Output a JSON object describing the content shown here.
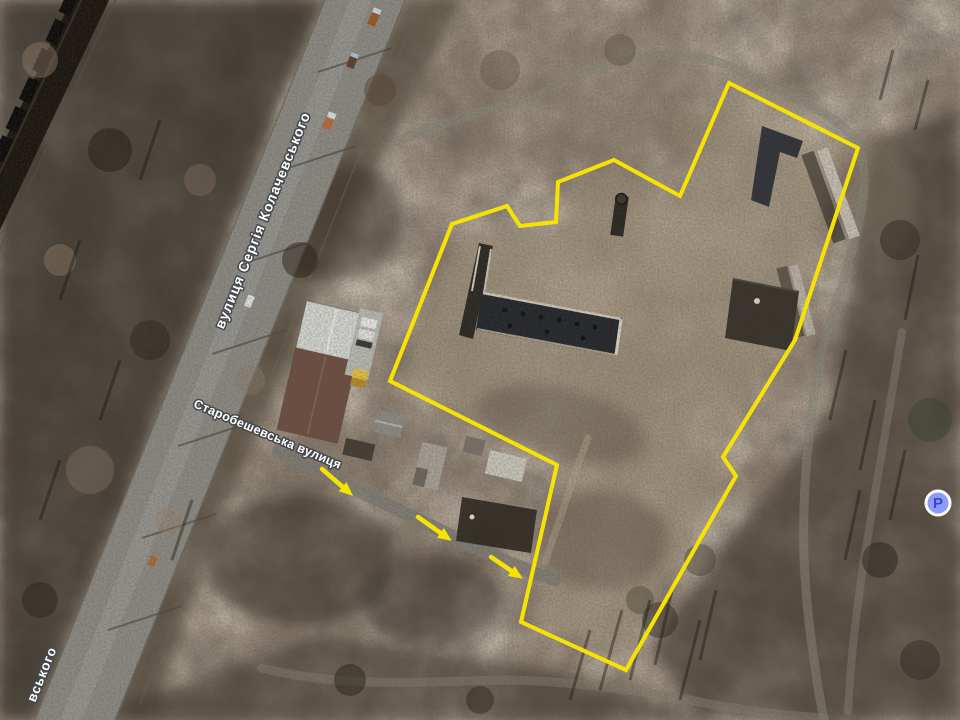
{
  "page": {
    "kind": "satellite-map-screenshot",
    "width": 960,
    "height": 720
  },
  "map": {
    "imagery": "satellite-autumn",
    "streets": {
      "main": {
        "label": "вулиця Сергія Колачевського"
      },
      "secondary": {
        "label": "Старобешевська вулиця"
      },
      "fragment": {
        "label": "вського"
      }
    },
    "poi": {
      "parking": {
        "icon": "parking-icon",
        "letter": "P",
        "circle_color": "#8a9cf7",
        "letter_color": "#3847c0",
        "ring_color": "#ffffff"
      }
    },
    "annotation": {
      "color": "#f6e303",
      "site_outline_points": "729,83 858,148 795,340 723,457 736,476 626,670 521,622 557,465 390,381 452,224 507,206 520,226 556,222 558,182 614,160 680,196",
      "arrows": [
        {
          "x1": 322,
          "y1": 469,
          "x2": 344,
          "y2": 488
        },
        {
          "x1": 418,
          "y1": 517,
          "x2": 442,
          "y2": 534
        },
        {
          "x1": 491,
          "y1": 557,
          "x2": 513,
          "y2": 572
        }
      ]
    },
    "label_style": {
      "fill": "#ffffff",
      "outline": "#45494d"
    }
  }
}
